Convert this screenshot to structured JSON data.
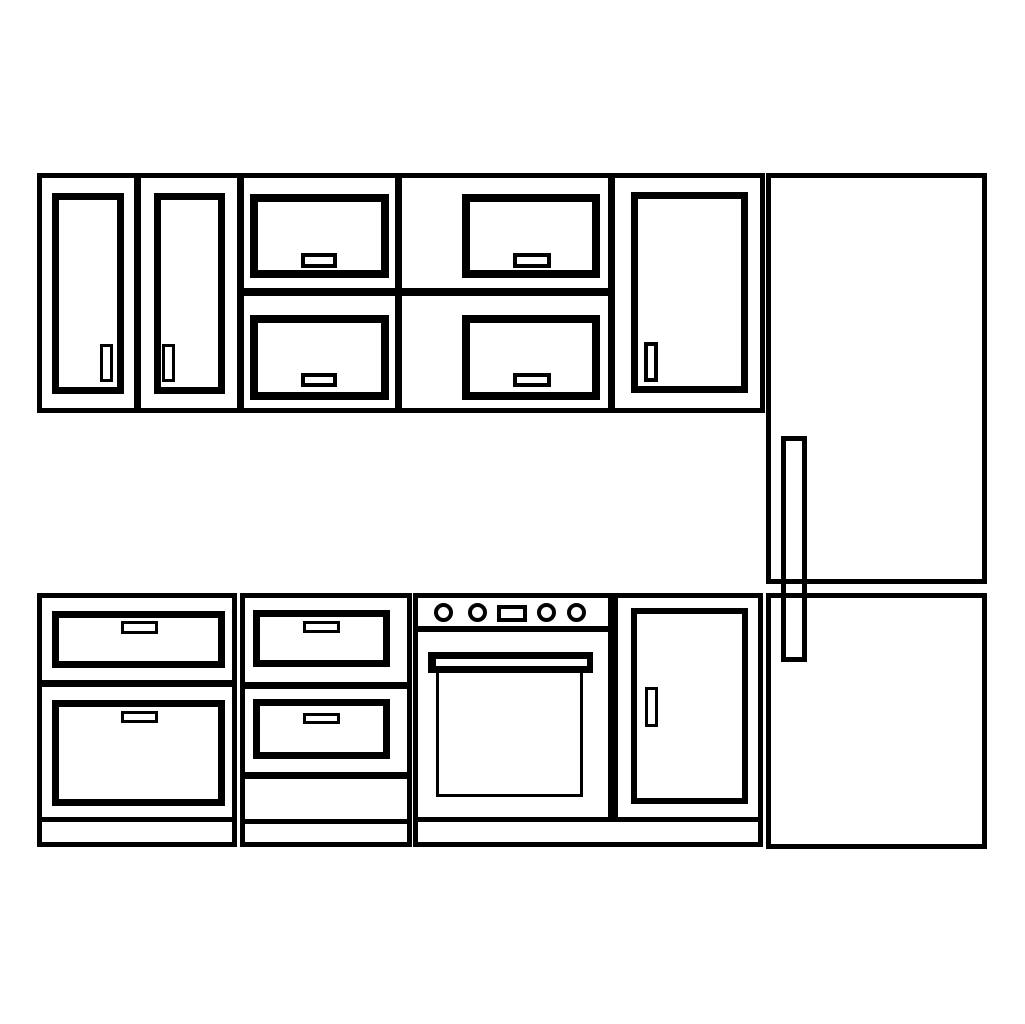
{
  "canvas": {
    "width": 1025,
    "height": 1024,
    "background_color": "#ffffff",
    "line_color": "#000000",
    "description": "kitchen-cabinet-elevation-line-drawing"
  },
  "shapes": [
    {
      "name": "upper-cabinet-1-frame",
      "type": "rect",
      "x": 37,
      "y": 173,
      "w": 102,
      "h": 240,
      "stroke": 5
    },
    {
      "name": "upper-cabinet-1-door",
      "type": "rect",
      "x": 52,
      "y": 193,
      "w": 72,
      "h": 201,
      "stroke": 7
    },
    {
      "name": "upper-cabinet-1-door-handle",
      "type": "rect",
      "x": 100,
      "y": 344,
      "w": 13,
      "h": 38,
      "stroke": 3
    },
    {
      "name": "upper-cabinet-2-frame",
      "type": "rect",
      "x": 136,
      "y": 173,
      "w": 106,
      "h": 240,
      "stroke": 5
    },
    {
      "name": "upper-cabinet-2-door",
      "type": "rect",
      "x": 154,
      "y": 193,
      "w": 71,
      "h": 201,
      "stroke": 7
    },
    {
      "name": "upper-cabinet-2-door-handle",
      "type": "rect",
      "x": 162,
      "y": 344,
      "w": 13,
      "h": 38,
      "stroke": 3
    },
    {
      "name": "upper-cabinet-3-frame",
      "type": "rect",
      "x": 239,
      "y": 173,
      "w": 161,
      "h": 240,
      "stroke": 5
    },
    {
      "name": "upper-cabinet-3-top-door",
      "type": "rect",
      "x": 250,
      "y": 194,
      "w": 139,
      "h": 84,
      "stroke": 8
    },
    {
      "name": "upper-cabinet-3-top-door-handle",
      "type": "rect",
      "x": 301,
      "y": 253,
      "w": 36,
      "h": 15,
      "stroke": 4
    },
    {
      "name": "upper-cabinet-3-divider",
      "type": "bar",
      "x": 239,
      "y": 288,
      "w": 161,
      "h": 8
    },
    {
      "name": "upper-cabinet-3-bottom-door",
      "type": "rect",
      "x": 250,
      "y": 315,
      "w": 139,
      "h": 85,
      "stroke": 8
    },
    {
      "name": "upper-cabinet-3-bottom-door-handle",
      "type": "rect",
      "x": 301,
      "y": 373,
      "w": 36,
      "h": 14,
      "stroke": 4
    },
    {
      "name": "upper-cabinet-4-frame",
      "type": "rect",
      "x": 397,
      "y": 173,
      "w": 216,
      "h": 240,
      "stroke": 5
    },
    {
      "name": "upper-cabinet-4-top-door",
      "type": "rect",
      "x": 462,
      "y": 194,
      "w": 138,
      "h": 84,
      "stroke": 8
    },
    {
      "name": "upper-cabinet-4-top-door-handle",
      "type": "rect",
      "x": 513,
      "y": 253,
      "w": 38,
      "h": 15,
      "stroke": 4
    },
    {
      "name": "upper-cabinet-4-divider",
      "type": "bar",
      "x": 397,
      "y": 288,
      "w": 216,
      "h": 8
    },
    {
      "name": "upper-cabinet-4-bottom-door",
      "type": "rect",
      "x": 462,
      "y": 315,
      "w": 138,
      "h": 85,
      "stroke": 8
    },
    {
      "name": "upper-cabinet-4-bottom-door-handle",
      "type": "rect",
      "x": 513,
      "y": 373,
      "w": 38,
      "h": 14,
      "stroke": 4
    },
    {
      "name": "upper-cabinet-5-frame",
      "type": "rect",
      "x": 610,
      "y": 173,
      "w": 155,
      "h": 240,
      "stroke": 5
    },
    {
      "name": "upper-cabinet-5-door",
      "type": "rect",
      "x": 631,
      "y": 192,
      "w": 117,
      "h": 201,
      "stroke": 7
    },
    {
      "name": "upper-cabinet-5-door-handle",
      "type": "rect",
      "x": 644,
      "y": 342,
      "w": 14,
      "h": 40,
      "stroke": 4
    },
    {
      "name": "refrigerator-handle",
      "type": "rect",
      "x": 781,
      "y": 436,
      "w": 26,
      "h": 226,
      "stroke": 5
    },
    {
      "name": "refrigerator-upper-door",
      "type": "rect-open",
      "x": 766,
      "y": 173,
      "w": 221,
      "h": 411,
      "stroke": 5
    },
    {
      "name": "refrigerator-lower-door",
      "type": "rect-open",
      "x": 766,
      "y": 593,
      "w": 221,
      "h": 256,
      "stroke": 5
    },
    {
      "name": "base-cabinet-1-frame",
      "type": "rect",
      "x": 37,
      "y": 593,
      "w": 200,
      "h": 254,
      "stroke": 5
    },
    {
      "name": "base-cabinet-1-top-drawer",
      "type": "rect",
      "x": 52,
      "y": 611,
      "w": 173,
      "h": 57,
      "stroke": 7
    },
    {
      "name": "base-cabinet-1-top-drawer-handle",
      "type": "rect",
      "x": 121,
      "y": 621,
      "w": 37,
      "h": 13,
      "stroke": 3
    },
    {
      "name": "base-cabinet-1-divider",
      "type": "bar",
      "x": 37,
      "y": 680,
      "w": 200,
      "h": 7
    },
    {
      "name": "base-cabinet-1-bottom-drawer",
      "type": "rect",
      "x": 52,
      "y": 700,
      "w": 173,
      "h": 106,
      "stroke": 7
    },
    {
      "name": "base-cabinet-1-bottom-drawer-handle",
      "type": "rect",
      "x": 121,
      "y": 711,
      "w": 37,
      "h": 12,
      "stroke": 3
    },
    {
      "name": "base-cabinet-2-frame",
      "type": "rect",
      "x": 240,
      "y": 593,
      "w": 172,
      "h": 254,
      "stroke": 5
    },
    {
      "name": "base-cabinet-2-top-drawer",
      "type": "rect",
      "x": 253,
      "y": 610,
      "w": 137,
      "h": 57,
      "stroke": 7
    },
    {
      "name": "base-cabinet-2-top-drawer-handle",
      "type": "rect",
      "x": 303,
      "y": 621,
      "w": 37,
      "h": 12,
      "stroke": 3
    },
    {
      "name": "base-cabinet-2-upper-divider",
      "type": "bar",
      "x": 240,
      "y": 682,
      "w": 172,
      "h": 7
    },
    {
      "name": "base-cabinet-2-bottom-drawer",
      "type": "rect",
      "x": 253,
      "y": 699,
      "w": 137,
      "h": 60,
      "stroke": 7
    },
    {
      "name": "base-cabinet-2-bottom-drawer-handle",
      "type": "rect",
      "x": 303,
      "y": 713,
      "w": 37,
      "h": 11,
      "stroke": 3
    },
    {
      "name": "base-cabinet-2-lower-divider",
      "type": "bar",
      "x": 240,
      "y": 772,
      "w": 172,
      "h": 7
    },
    {
      "name": "stove-frame",
      "type": "rect",
      "x": 413,
      "y": 593,
      "w": 200,
      "h": 254,
      "stroke": 5
    },
    {
      "name": "stove-control-panel-line",
      "type": "bar",
      "x": 413,
      "y": 626,
      "w": 200,
      "h": 6
    },
    {
      "name": "stove-knob-1",
      "type": "circle",
      "x": 434,
      "y": 603,
      "w": 19,
      "h": 19,
      "stroke": 4
    },
    {
      "name": "stove-knob-2",
      "type": "circle",
      "x": 468,
      "y": 603,
      "w": 19,
      "h": 19,
      "stroke": 4
    },
    {
      "name": "stove-display",
      "type": "rect",
      "x": 497,
      "y": 605,
      "w": 30,
      "h": 17,
      "stroke": 4
    },
    {
      "name": "stove-knob-3",
      "type": "circle",
      "x": 537,
      "y": 603,
      "w": 19,
      "h": 19,
      "stroke": 4
    },
    {
      "name": "stove-knob-4",
      "type": "circle",
      "x": 567,
      "y": 603,
      "w": 19,
      "h": 19,
      "stroke": 4
    },
    {
      "name": "oven-door",
      "type": "rect",
      "x": 436,
      "y": 666,
      "w": 147,
      "h": 131,
      "stroke": 3
    },
    {
      "name": "oven-handle-bar",
      "type": "bar",
      "x": 428,
      "y": 652,
      "w": 165,
      "h": 21
    },
    {
      "name": "oven-handle-slot",
      "type": "slot",
      "x": 436,
      "y": 659,
      "w": 151,
      "h": 7
    },
    {
      "name": "base-cabinet-3-frame",
      "type": "rect",
      "x": 613,
      "y": 593,
      "w": 150,
      "h": 254,
      "stroke": 5
    },
    {
      "name": "base-cabinet-3-door",
      "type": "rect",
      "x": 631,
      "y": 608,
      "w": 117,
      "h": 196,
      "stroke": 6
    },
    {
      "name": "base-cabinet-3-door-handle",
      "type": "rect",
      "x": 645,
      "y": 687,
      "w": 13,
      "h": 40,
      "stroke": 3
    },
    {
      "name": "base-cabinet-1-toe-kick",
      "type": "rect",
      "x": 37,
      "y": 817,
      "w": 200,
      "h": 30,
      "stroke": 5
    },
    {
      "name": "base-cabinet-2-toe-kick",
      "type": "rect",
      "x": 240,
      "y": 819,
      "w": 172,
      "h": 28,
      "stroke": 5
    },
    {
      "name": "stove-and-cabinet-3-toe-kick",
      "type": "rect",
      "x": 413,
      "y": 817,
      "w": 350,
      "h": 30,
      "stroke": 5
    }
  ]
}
